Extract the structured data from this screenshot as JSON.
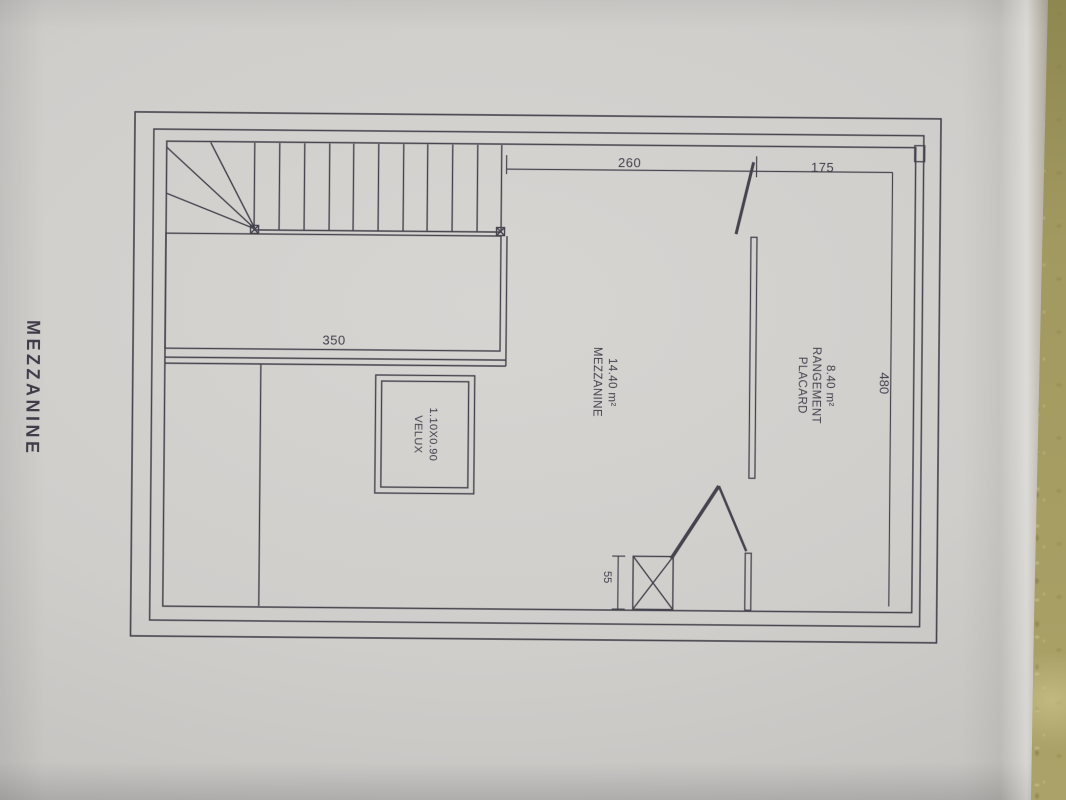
{
  "document": {
    "sheet_title": "MEZZANINE",
    "labels": {
      "room_mezzanine": {
        "line1": "MEZZANINE",
        "line2": "14.40 m²"
      },
      "room_placard": {
        "line1": "PLACARD",
        "line2": "RANGEMENT",
        "line3": "8.40 m²"
      },
      "velux": {
        "line1": "VELUX",
        "line2": "1.10X0.90"
      }
    },
    "dimensions": {
      "d260": "260",
      "d175": "175",
      "d350": "350",
      "d480": "480",
      "d55": "55"
    }
  },
  "colors": {
    "paper": "#d0cecb",
    "ink": "#45444e",
    "table_cloth": "#a19960"
  }
}
